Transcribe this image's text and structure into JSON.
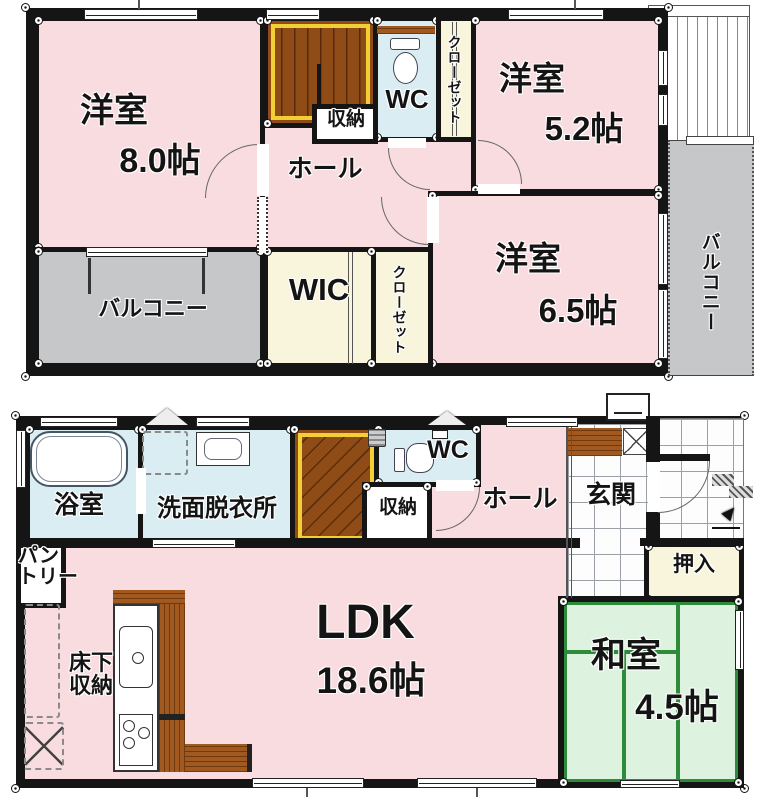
{
  "plan_title": "2-story house floor plan",
  "f2": {
    "yoshitsu8": {
      "name": "洋室",
      "size": "8.0帖"
    },
    "yoshitsu52": {
      "name": "洋室",
      "size": "5.2帖"
    },
    "yoshitsu65": {
      "name": "洋室",
      "size": "6.5帖"
    },
    "wc": "WC",
    "closet_top": "クローゼット",
    "closet_mid": "クローゼット",
    "storage": "収納",
    "hall": "ホール",
    "wic": "WIC",
    "balcony_left": "バルコニー",
    "balcony_right": "バルコニー"
  },
  "f1": {
    "bath": "浴室",
    "washroom": "洗面脱衣所",
    "wc": "WC",
    "storage": "収納",
    "hall": "ホール",
    "entrance": "玄関",
    "pantry": "パン\nトリー",
    "underfloor": "床下\n収納",
    "ldk": {
      "name": "LDK",
      "size": "18.6帖"
    },
    "washitsu": {
      "name": "和室",
      "size": "4.5帖"
    },
    "oshiire": "押入"
  },
  "colors": {
    "wall": "#151515",
    "room_pink": "#f9dce0",
    "wet_blue": "#d9edf2",
    "closet_cream": "#f8f5dc",
    "balcony_gray": "#c6c7c9",
    "tatami_green": "#def3df",
    "tatami_line": "#2e8b3a",
    "stair_brown": "#8f4c16",
    "stair_yellow": "#f2cf35",
    "counter_brown": "#a2591f"
  }
}
